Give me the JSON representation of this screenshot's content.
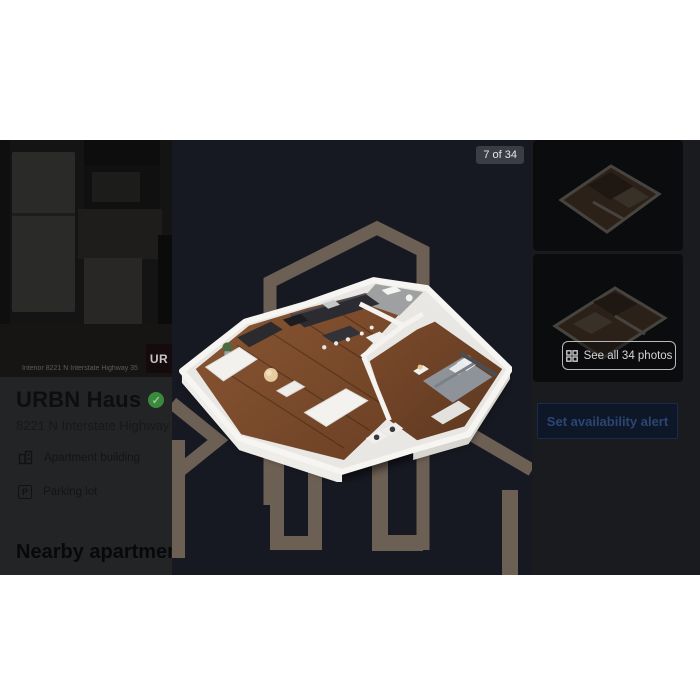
{
  "lightbox": {
    "counter": "7 of 34",
    "see_all_label": "See all 34 photos",
    "alert_label": "Set availability alert"
  },
  "listing": {
    "photo_caption": "Interior 8221 N Interstate Highway 35",
    "logo_badge": "UR",
    "title": "URBN Haus",
    "verified_mark": "✓",
    "address": "8221 N Interstate Highway 35",
    "amenities": [
      {
        "label": "Apartment building"
      },
      {
        "label": "Parking lot"
      }
    ],
    "nearby_heading": "Nearby apartments for"
  },
  "icons": {
    "parking_letter": "P"
  },
  "colors": {
    "viewer_bg": "#171922",
    "watermark_brown": "#6c5f54",
    "verified_green": "#3a8a3e",
    "alert_button_bg": "#0d1727",
    "alert_button_text": "#2c4573"
  }
}
